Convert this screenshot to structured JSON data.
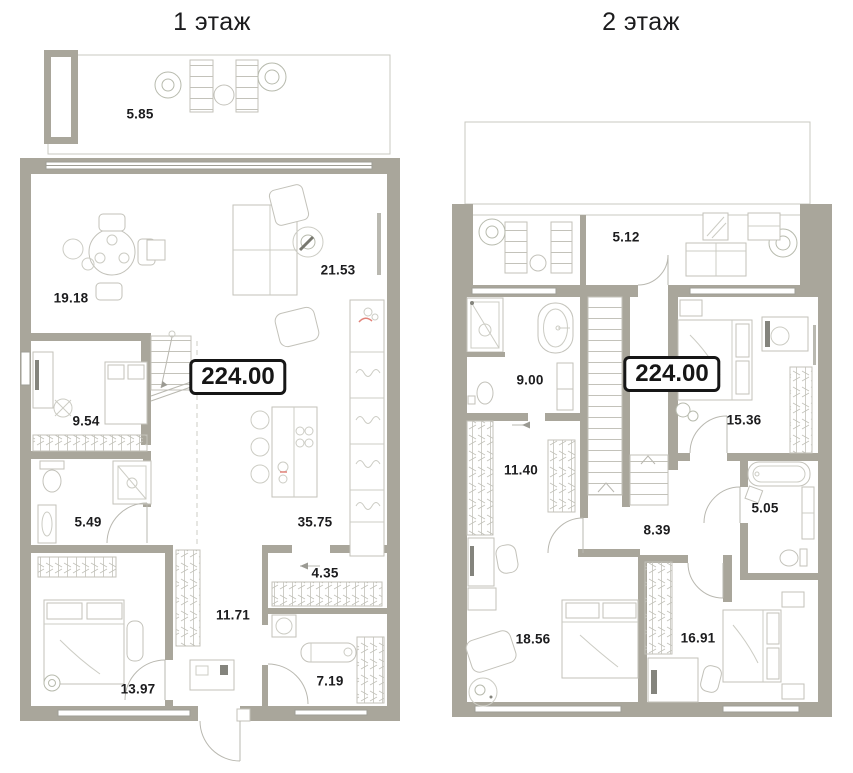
{
  "floors": [
    {
      "title": "1 этаж",
      "total_area": "224.00",
      "room_areas": [
        "5.85",
        "19.18",
        "21.53",
        "9.54",
        "5.49",
        "35.75",
        "4.35",
        "11.71",
        "13.97",
        "7.19"
      ]
    },
    {
      "title": "2 этаж",
      "total_area": "224.00",
      "room_areas": [
        "5.12",
        "9.00",
        "15.36",
        "11.40",
        "8.39",
        "5.05",
        "18.56",
        "16.91"
      ]
    }
  ],
  "colors": {
    "wall": "#a9a69b",
    "furniture_line": "#c3c2ba",
    "window_line": "#9e9d95",
    "accent_red": "#e2837a",
    "text": "#1c1c1e"
  }
}
